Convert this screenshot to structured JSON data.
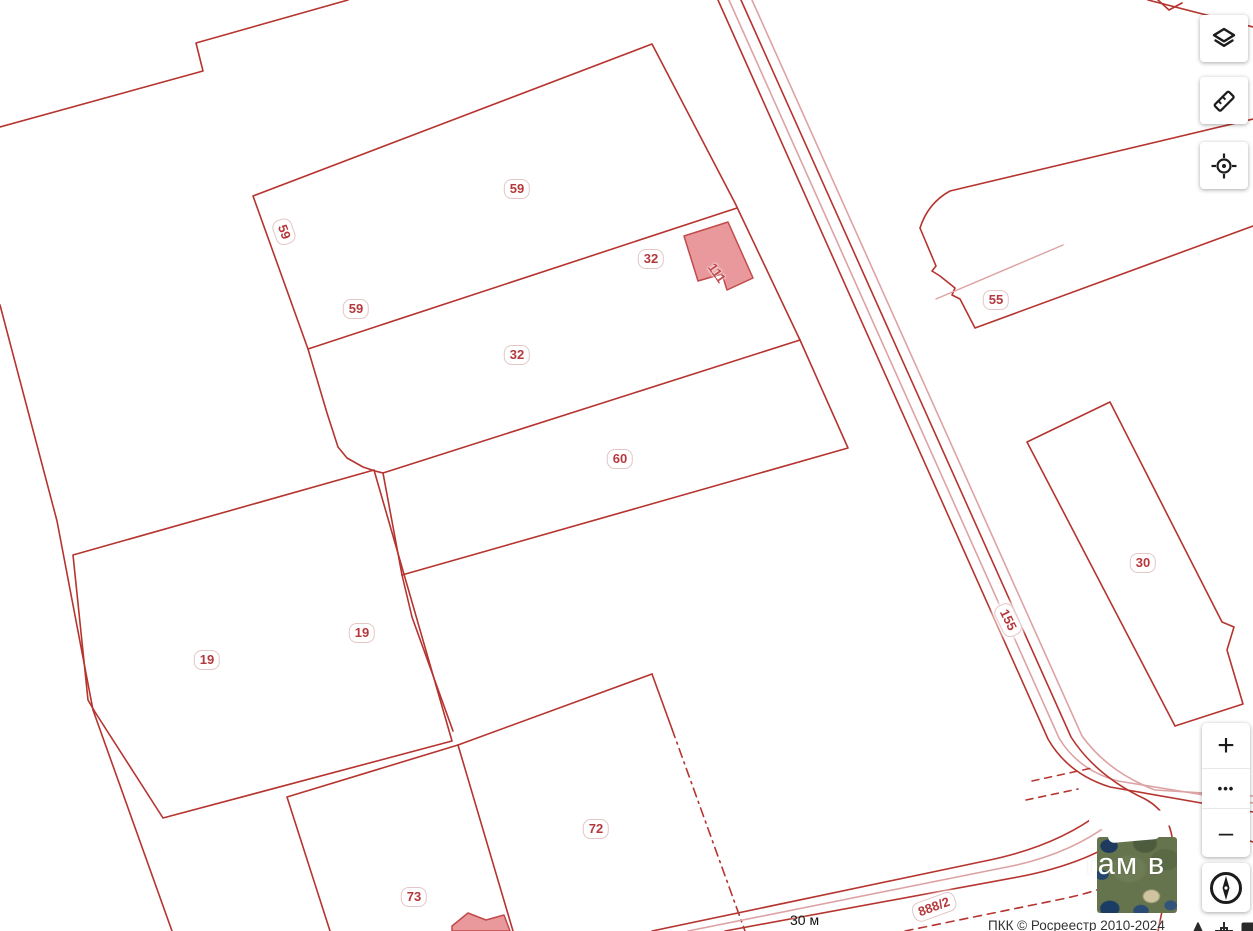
{
  "map": {
    "labels": [
      {
        "text": "59"
      },
      {
        "text": "59"
      },
      {
        "text": "59"
      },
      {
        "text": "32"
      },
      {
        "text": "32"
      },
      {
        "text": "60"
      },
      {
        "text": "19"
      },
      {
        "text": "19"
      },
      {
        "text": "72"
      },
      {
        "text": "73"
      },
      {
        "text": "55"
      },
      {
        "text": "30"
      }
    ],
    "building_label": "111",
    "road_label_155": "155",
    "road_label_888": "888/2",
    "overlay_label": "гам в",
    "scale_label": "30 м",
    "attribution": "ПКК © Росреестр 2010-2024"
  },
  "controls": {
    "zoom_in": "+",
    "more": "•••",
    "zoom_out": "–"
  },
  "colors": {
    "parcel_line": "#b5342f",
    "faint_line": "#dda2a4",
    "building_fill": "#e9989c",
    "building_stroke": "#c24a4a",
    "label_red": "#b5383c",
    "control_icon": "#1c1c1c",
    "attribution_text": "#333333"
  }
}
